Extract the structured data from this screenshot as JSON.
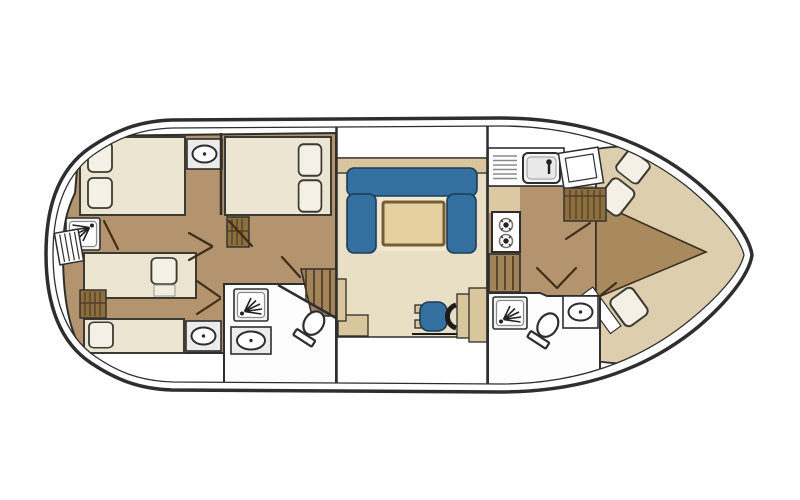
{
  "diagram": {
    "kind": "houseboat deck floor plan, top view",
    "orientation": "bow right, stern left"
  },
  "colors": {
    "hull": "#2e2e2e",
    "deck": "#ffffff",
    "floor_aft": "#b3946f",
    "floor_bow": "#a98a5e",
    "floor_salon": "#e9dfc5",
    "salon_inner": "#efe8d3",
    "galley_light": "#dcc9a4",
    "trim": "#d9c69c",
    "table_top": "#e4d0a0",
    "table_edge": "#7a5c33",
    "bed": "#ece5d2",
    "pillow": "#f4f0e5",
    "bow_bed": "#ddcfae",
    "wood": "#8d6f3e",
    "stairs": "#a2835a",
    "sofa": "#33709f",
    "door": "#3f2e17"
  },
  "rooms": {
    "aft_cabin_left": {
      "furniture": [
        "double-bed",
        "two-pillows",
        "washbasin",
        "shower"
      ]
    },
    "aft_cabin_right": {
      "furniture": [
        "double-bed",
        "two-pillows",
        "wardrobe"
      ]
    },
    "aft_cabin_lower": {
      "furniture": [
        "single-bed",
        "single-bed",
        "wardrobe",
        "washbasin"
      ]
    },
    "aft_bathroom": {
      "furniture": [
        "shower",
        "washbasin",
        "toilet"
      ]
    },
    "companionway_aft": {
      "furniture": [
        "stairs",
        "landing-step"
      ]
    },
    "salon": {
      "furniture": [
        "u-shaped-sofa",
        "table",
        "helm-seat",
        "steering-wheel",
        "console",
        "side-cabinet"
      ]
    },
    "galley": {
      "furniture": [
        "counter",
        "drainer",
        "sink",
        "two-burner-stove",
        "louvered-steps",
        "wardrobe",
        "tilted-counter"
      ]
    },
    "bow_bathroom": {
      "furniture": [
        "shower",
        "toilet",
        "washbasin"
      ]
    },
    "bow_cabin": {
      "furniture": [
        "v-berth-upper",
        "v-berth-lower",
        "three-pillows"
      ]
    },
    "exterior": {
      "furniture": [
        "boarding-steps"
      ]
    }
  }
}
